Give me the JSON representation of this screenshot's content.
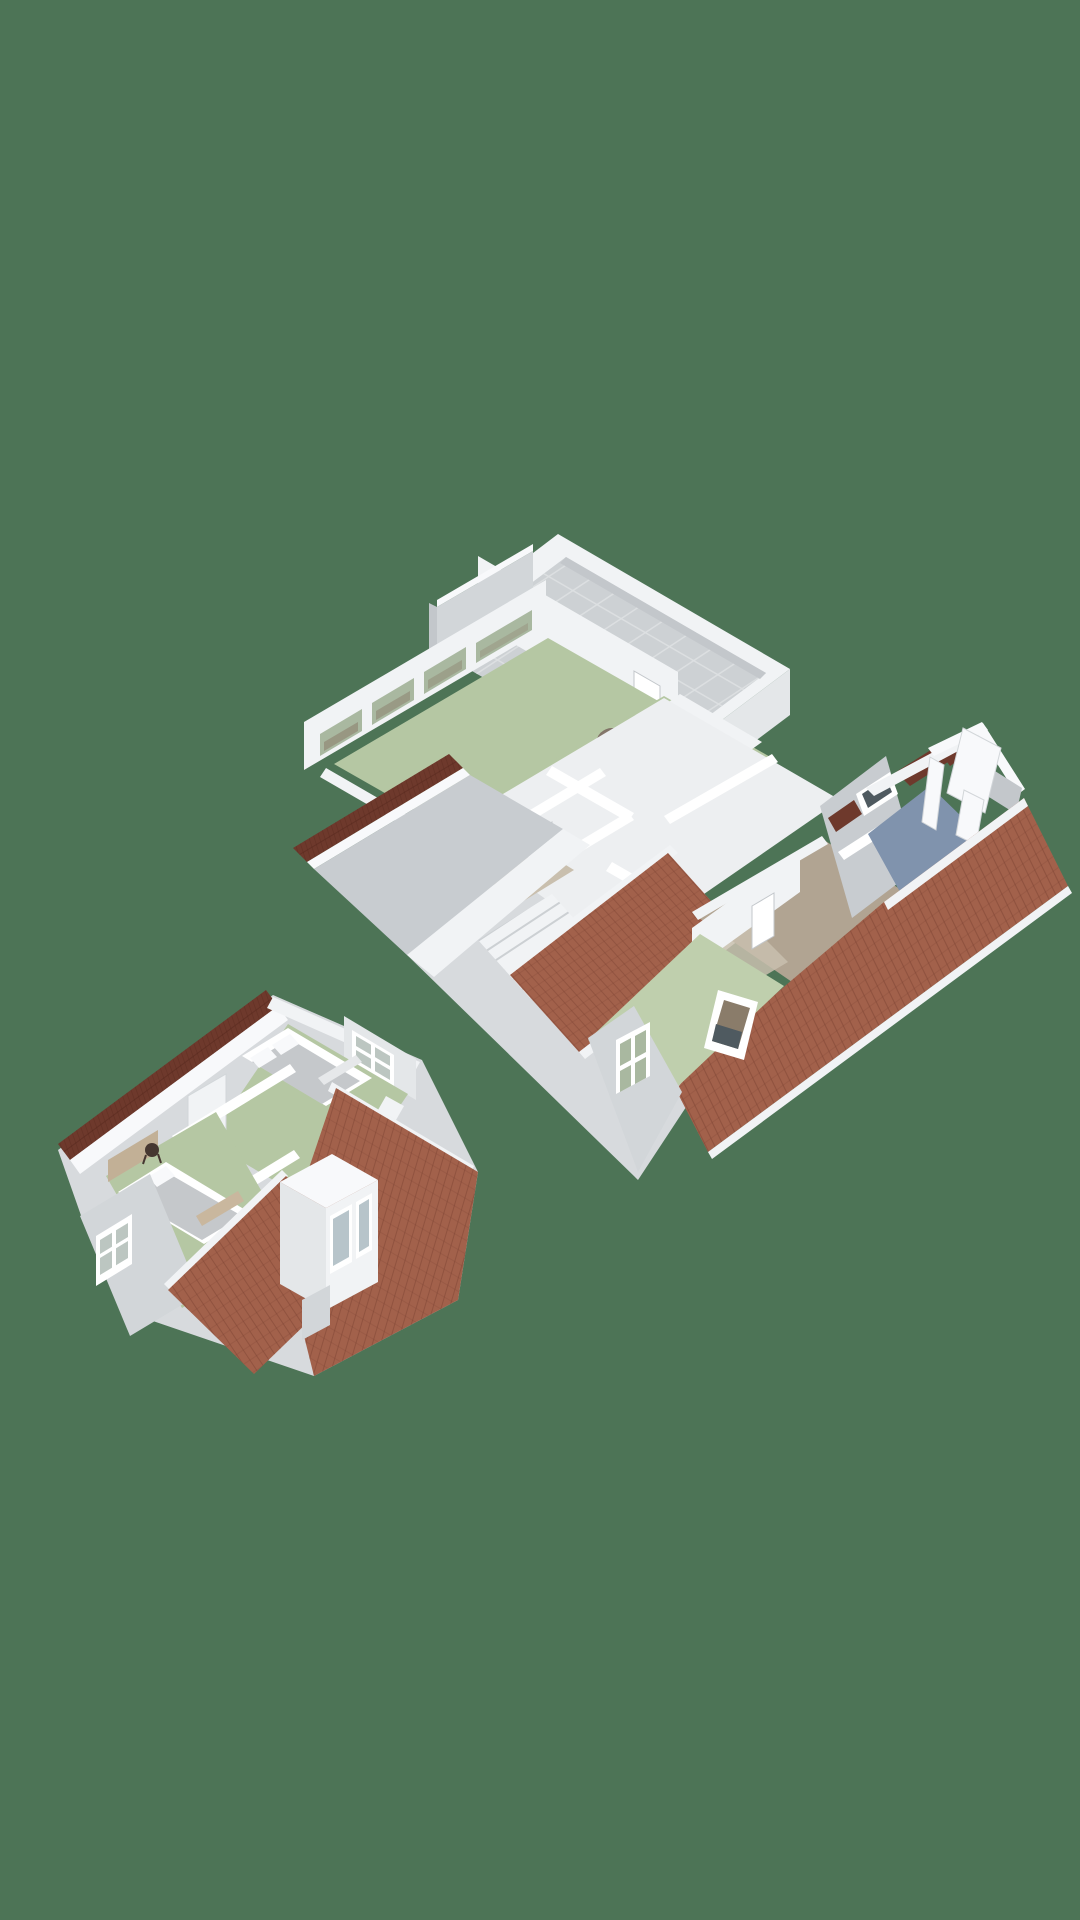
{
  "canvas": {
    "width": 1080,
    "height": 1920
  },
  "palette": {
    "background": "#4d7456",
    "wall_bright": "#f8f9fb",
    "wall_light": "#f1f3f5",
    "wall_mid": "#e4e7e9",
    "wall_shade": "#d2d6d9",
    "wall_dark": "#c3c7cb",
    "gray_roof": "#c8ccd0",
    "slab": "#d7dadd",
    "hall_floor": "#edeff1",
    "deck": "#cdd1d4",
    "deck_line": "#dde0e2",
    "green_floor": "#b5c7a3",
    "green_floor_light": "#bfcfad",
    "blue_floor": "#8093ad",
    "tan_floor": "#b1a492",
    "tan_light": "#c9bfae",
    "roof_main": "#a2614b",
    "roof_line": "#7b4333",
    "roof_maroon": "#6e392c",
    "maroon_line": "#57291e",
    "headboard": "#c2b096",
    "blanket": "#c9b79e",
    "glass_green": "#a9b8a0",
    "glass_murky": "#8a7c6a",
    "glass_cool": "#bcc6c1",
    "glass_blue": "#b7c4ca",
    "glass_dark": "#4f5a60",
    "bed_gray": "#c5c8cb",
    "bed_fold": "#e6e8ea",
    "white": "#ffffff",
    "pouf_hi": "#97897c",
    "pouf_lo": "#62544a",
    "stool": "#463731",
    "shadow": "#2f3b33"
  },
  "scene": {
    "type": "3d-floorplan-render",
    "projection": "axonometric",
    "models": [
      {
        "id": "upper-floor",
        "position": "top-right",
        "features": {
          "terrace": {
            "floor": "gray-tiles",
            "parapet": true
          },
          "rooms": [
            {
              "floor": "green",
              "objects": [
                "pouf",
                "window-strip"
              ]
            },
            {
              "floor": "green",
              "objects": [
                "roof-window-frame",
                "gable-window"
              ]
            },
            {
              "floor": "blue",
              "objects": [
                "cut-wall-panels"
              ]
            },
            {
              "floor": "tan",
              "objects": []
            },
            {
              "floor": "tan-light",
              "objects": [
                "toilet",
                "sink"
              ]
            }
          ],
          "hallway": {
            "objects": [
              "staircase",
              "doors"
            ]
          },
          "roofs": [
            "terracotta-central",
            "terracotta-right-wing",
            "dark-red-strip",
            "gray-slope"
          ]
        }
      },
      {
        "id": "attic-floor",
        "position": "bottom-left",
        "features": {
          "rooms": [
            {
              "floor": "green",
              "objects": [
                "double-bed",
                "gable-window"
              ]
            },
            {
              "floor": "green",
              "objects": [
                "double-bed",
                "stool",
                "headboard-wall",
                "gable-window"
              ]
            },
            {
              "type": "bathroom",
              "objects": [
                "bathtub",
                "toilet"
              ]
            }
          ],
          "roofs": [
            "terracotta-right",
            "terracotta-bottom",
            "dark-red-strip"
          ],
          "dormer": {
            "windows": 2
          }
        }
      }
    ]
  }
}
